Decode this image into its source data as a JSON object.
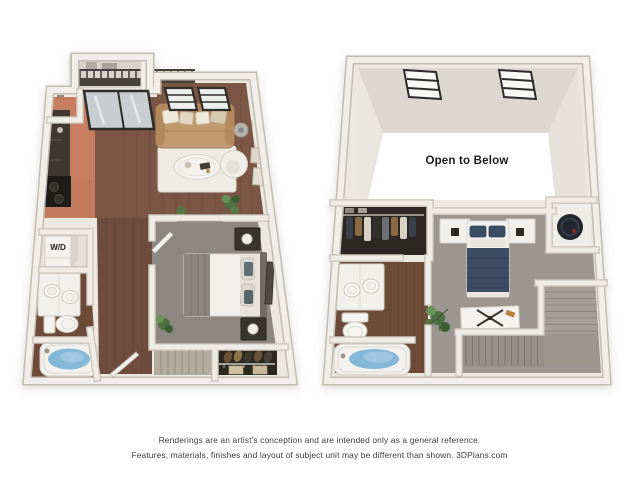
{
  "page": {
    "background": "#ffffff"
  },
  "first_floor": {
    "labels": {
      "washer_dryer": "W/D"
    },
    "rooms": [
      "balcony",
      "kitchen",
      "living-room",
      "bedroom",
      "bathroom",
      "laundry-closet",
      "hallway",
      "stairs",
      "shoe-closet",
      "entry-closet"
    ]
  },
  "second_floor": {
    "labels": {
      "open_to_below": "Open to Below"
    },
    "rooms": [
      "vaulted-open-area",
      "loft-bedroom",
      "walk-in-closet",
      "bathroom",
      "utility-closet",
      "stairs"
    ]
  },
  "disclaimer": {
    "line1": "Renderings are an artist's conception and are intended only as a general reference.",
    "line2": "Features, materials, finishes and layout of subject unit may be different than shown. 3DPlans.com"
  },
  "colors": {
    "background": "#ffffff",
    "wall": "#ebe8e2",
    "wall_edge": "#c9c3b8",
    "ceiling_face": "#dcd7cf",
    "void_white": "#ffffff",
    "terracotta": "#c47a5c",
    "wood": "#7b5645",
    "wood_dark": "#6f4c3d",
    "bath_wood": "#6e4a38",
    "carpet_first": "#8c8881",
    "carpet_loft": "#9b968f",
    "stairs_light": "#b3ab9e",
    "stairs_loft": "#a59f95",
    "navy": "#3b4d63",
    "sofa_tan": "#c0996e",
    "rug": "#eeebe4",
    "water_blue": "#85b7d7",
    "counter_dark": "#3f3831",
    "island_gray": "#515055",
    "closet_dark": "#2b2823",
    "accent_red": "#9e2f22",
    "plant_green": "#4f7040",
    "heater_dark": "#23262e",
    "railing_dark": "#45423e",
    "frame_dark": "#2f2d29",
    "disclaimer_text": "#3d3d3d"
  }
}
